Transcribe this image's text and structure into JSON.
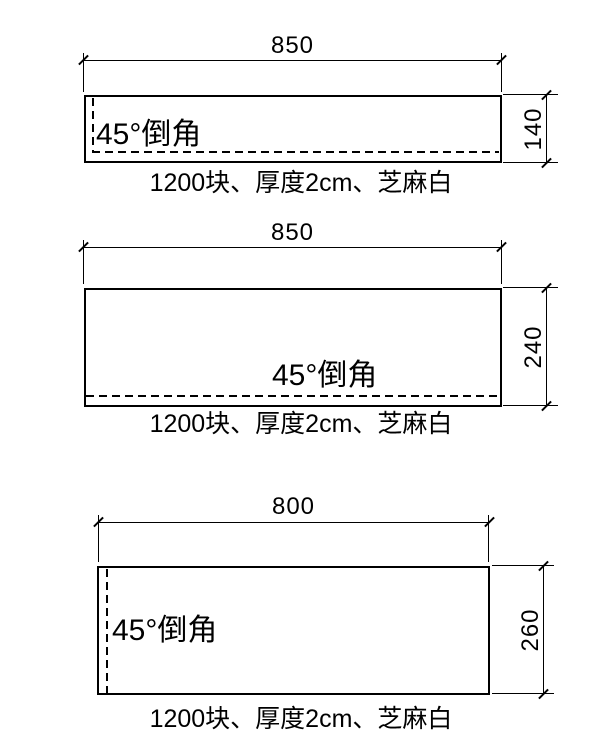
{
  "drawing": {
    "background_color": "#ffffff",
    "line_color": "#000000",
    "panels": [
      {
        "width_label": "850",
        "height_label": "140",
        "chamfer_label": "45°倒角",
        "caption": "1200块、厚度2cm、芝麻白",
        "chamfer_edges": "left-and-bottom"
      },
      {
        "width_label": "850",
        "height_label": "240",
        "chamfer_label": "45°倒角",
        "caption": "1200块、厚度2cm、芝麻白",
        "chamfer_edges": "bottom"
      },
      {
        "width_label": "800",
        "height_label": "260",
        "chamfer_label": "45°倒角",
        "caption": "1200块、厚度2cm、芝麻白",
        "chamfer_edges": "left"
      }
    ]
  }
}
